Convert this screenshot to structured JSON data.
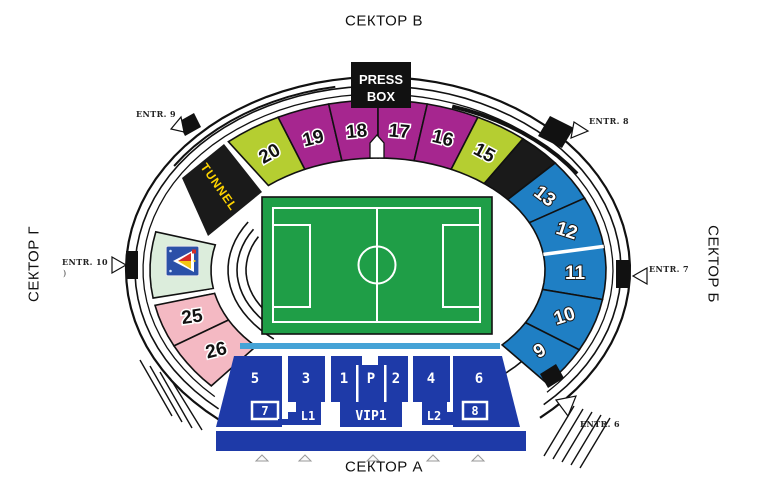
{
  "sectors": {
    "top": "СЕКТОР В",
    "bottom": "СЕКТОР А",
    "right": "СЕКТОР Б",
    "left": "СЕКТОР Г"
  },
  "pressbox": {
    "line1": "PRESS",
    "line2": "BOX"
  },
  "ring": {
    "tunnel_label": "TUNNEL",
    "colors": {
      "magenta": "#A6268F",
      "green": "#B5CE31",
      "blue": "#1F7FC4",
      "pink": "#F4B9C3",
      "pale_green": "#DCEDDC",
      "black": "#1A1A1A"
    },
    "sections": [
      {
        "label": "20",
        "color": "green",
        "a0": 116,
        "a1": 131,
        "rot": -30,
        "text": "dark"
      },
      {
        "label": "19",
        "color": "magenta",
        "a0": 102.5,
        "a1": 116,
        "rot": -14,
        "text": "dark"
      },
      {
        "label": "18",
        "color": "magenta",
        "a0": 90,
        "a1": 102.5,
        "rot": -5,
        "text": "dark"
      },
      {
        "label": "17",
        "color": "magenta",
        "a0": 77.5,
        "a1": 90,
        "rot": 5,
        "text": "dark"
      },
      {
        "label": "16",
        "color": "magenta",
        "a0": 64,
        "a1": 77.5,
        "rot": 14,
        "text": "dark"
      },
      {
        "label": "15",
        "color": "green",
        "a0": 50.5,
        "a1": 64,
        "rot": 28,
        "text": "dark"
      },
      {
        "label": "",
        "color": "black",
        "a0": 39,
        "a1": 50.5,
        "rot": 0,
        "text": "dark"
      },
      {
        "label": "13",
        "color": "blue",
        "a0": 25,
        "a1": 39,
        "rot": 38,
        "text": "white"
      },
      {
        "label": "12",
        "color": "blue",
        "a0": 8,
        "a1": 25,
        "rot": 18,
        "text": "white"
      },
      {
        "label": "11",
        "color": "blue",
        "a0": -10,
        "a1": 8,
        "rot": 0,
        "text": "white"
      },
      {
        "label": "10",
        "color": "blue",
        "a0": -28,
        "a1": -10,
        "rot": -18,
        "text": "white"
      },
      {
        "label": "9",
        "color": "blue",
        "a0": -42,
        "a1": -28,
        "rot": -32,
        "text": "white"
      },
      {
        "label": "",
        "color": "pale_green",
        "a0": 167,
        "a1": 189.5,
        "rot": 0,
        "text": "dark"
      },
      {
        "label": "25",
        "color": "pink",
        "a0": 192,
        "a1": 206.5,
        "rot": -8,
        "text": "dark"
      },
      {
        "label": "26",
        "color": "pink",
        "a0": 206.5,
        "a1": 223,
        "rot": -14,
        "text": "dark"
      }
    ]
  },
  "entrances": {
    "e6": "ENTR. 6",
    "e7": "ENTR. 7",
    "e8": "ENTR. 8",
    "e9": "ENTR. 9",
    "e10": "ENTR. 10",
    "e10_mark": ")"
  },
  "bottom_stand": {
    "blocks": {
      "b5": "5",
      "b3": "3",
      "b7": "7",
      "l1": "L1",
      "b1": "1",
      "p": "P",
      "b2": "2",
      "vip1": "VIP1",
      "b4": "4",
      "l2": "L2",
      "b8": "8",
      "b6": "6"
    }
  },
  "pitch": {
    "color": "#1F9E47"
  },
  "stand_color": "#1E3AA8",
  "walkway_color": "#45A3D6",
  "logo": {
    "name": "club-crest-logo",
    "bg": "#2B50A8"
  }
}
